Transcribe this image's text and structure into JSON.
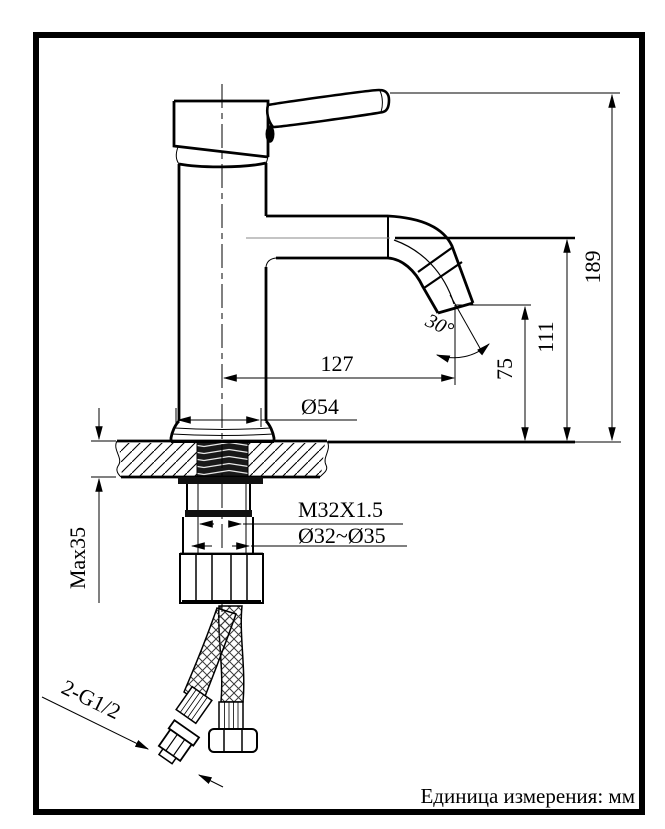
{
  "drawing": {
    "title": "Faucet installation dimensional drawing",
    "units_note": "Единица измерения: мм",
    "dimensions": {
      "overall_height": "189",
      "spout_height": "111",
      "outlet_height": "75",
      "spout_reach": "127",
      "base_diameter": "Ø54",
      "spout_angle": "30°",
      "shank_thread": "M32X1.5",
      "mounting_hole": "Ø32~Ø35",
      "max_deck_thickness": "Max35",
      "hose_thread": "2-G1/2"
    }
  }
}
